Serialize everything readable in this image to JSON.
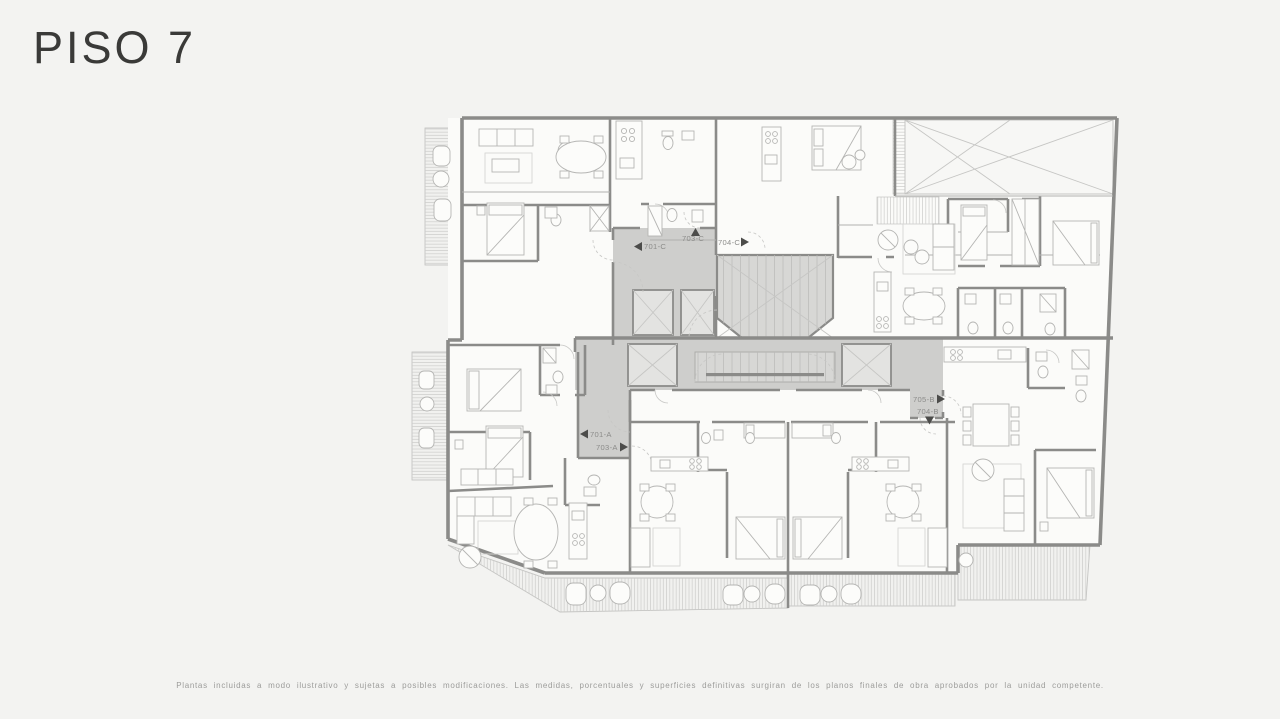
{
  "page": {
    "title": "PISO 7",
    "disclaimer": "Plantas incluidas a modo ilustrativo y sujetas a posibles modificaciones. Las medidas, porcentuales y superficies definitivas surgiran de los planos finales de obra aprobados por la unidad competente.",
    "background_color": "#f3f3f1",
    "title_color": "#3a3a38",
    "disclaimer_color": "#9c9c9a"
  },
  "plan": {
    "type": "architectural-floor-plan",
    "floor_label": "PISO 7",
    "units": [
      {
        "id": "701-C",
        "label": "701-C",
        "marker_direction": "left"
      },
      {
        "id": "703-C",
        "label": "703-C",
        "marker_direction": "up"
      },
      {
        "id": "704-C",
        "label": "704-C",
        "marker_direction": "right"
      },
      {
        "id": "701-A",
        "label": "701-A",
        "marker_direction": "left"
      },
      {
        "id": "703-A",
        "label": "703-A",
        "marker_direction": "right"
      },
      {
        "id": "705-B",
        "label": "705-B",
        "marker_direction": "right"
      },
      {
        "id": "704-B",
        "label": "704-B",
        "marker_direction": "down"
      }
    ],
    "colors": {
      "wall": "#8b8b89",
      "room_fill": "#fbfbf9",
      "core_fill": "#cececc",
      "stair_fill": "#d7d7d5",
      "elevator_fill": "#e3e3e1",
      "furniture_line": "#b5b5b3",
      "deck_line": "#cdcdcb",
      "label_text": "#8c8c8a",
      "marker": "#4c4c4a"
    }
  }
}
